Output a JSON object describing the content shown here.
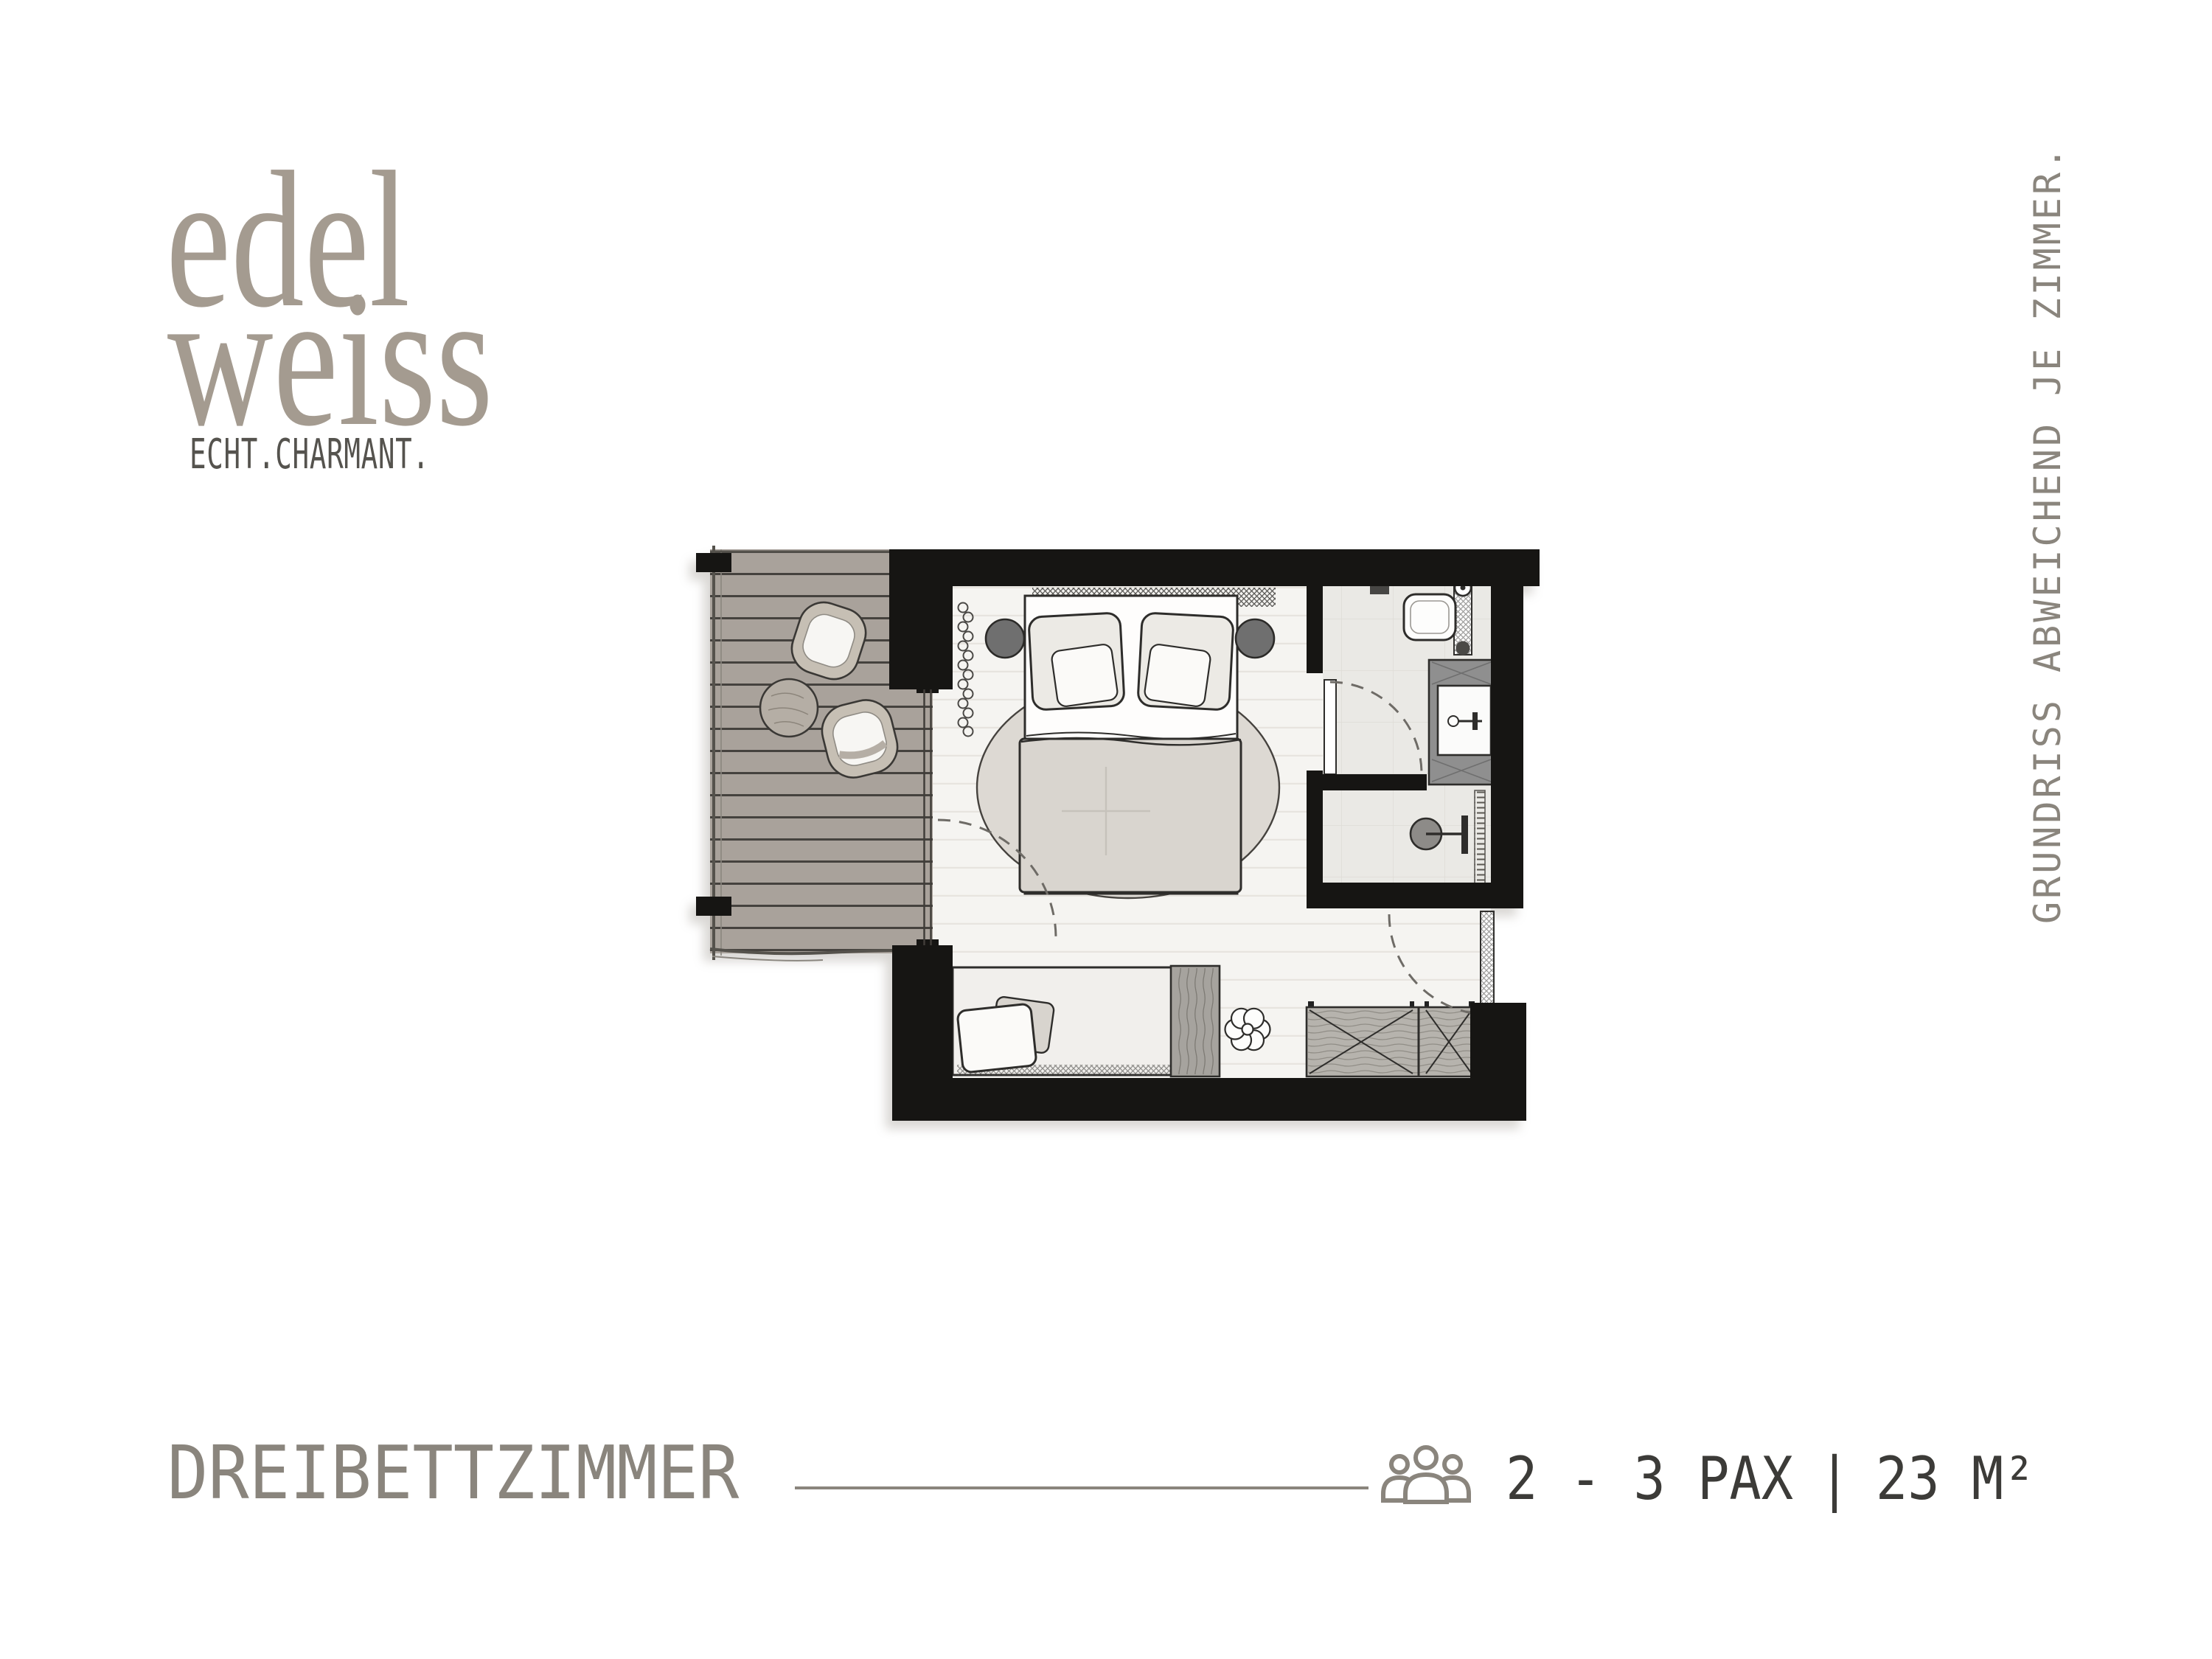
{
  "brand": {
    "logo_line1": "edel",
    "logo_line2": "weiss",
    "tagline": "ECHT.CHARMANT."
  },
  "side_note": "GRUNDRISS ABWEICHEND JE ZIMMER.",
  "footer": {
    "room_type": "DREIBETTZIMMER",
    "occupancy": "2 - 3 PAX",
    "separator": "|",
    "area": "23 M²",
    "people_icon": "people-group-icon"
  },
  "colors": {
    "logo": "#a49b90",
    "tagline": "#55534e",
    "footer_gray": "#8a857d",
    "footer_dark": "#3c3b38",
    "wall": "#161513",
    "deck": "#a9a29b",
    "rug": "#ddd9d3",
    "duvet": "#d9d5cf",
    "outline": "#2e2d2b",
    "background": "#ffffff"
  },
  "floor_plan": {
    "type": "hotel-room-floor-plan",
    "rooms": [
      "balcony",
      "bedroom",
      "bathroom",
      "entrance-hall"
    ],
    "furniture": [
      "balcony-table",
      "balcony-chairs",
      "double-bed",
      "nightstands",
      "round-rug",
      "radiator",
      "single-bed",
      "wardrobe-divider",
      "flower-stool",
      "luggage-bench",
      "toilet",
      "washbasin-vanity",
      "shower",
      "balcony-door",
      "bathroom-door",
      "entrance-door"
    ]
  }
}
